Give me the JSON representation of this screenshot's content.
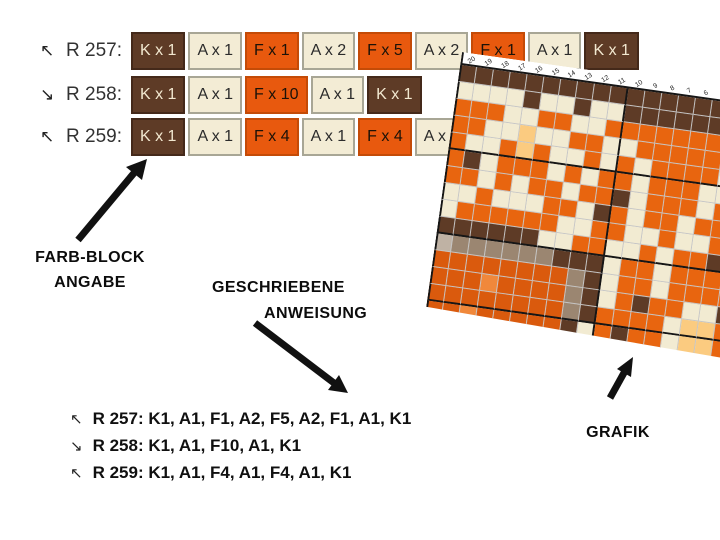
{
  "page": {
    "background": "#ffffff"
  },
  "block_colors": {
    "K": {
      "bg": "#5E3B26",
      "border": "#44291a",
      "meaning": "K"
    },
    "A": {
      "bg": "#F3ECD5",
      "border": "#a8a695",
      "meaning": "A"
    },
    "F": {
      "bg": "#E8590E",
      "border": "#c44b07",
      "meaning": "F"
    }
  },
  "instruction_rows": [
    {
      "arrow": "↖",
      "label": "R 257:",
      "blocks": [
        "K x 1",
        "A x 1",
        "F x 1",
        "A x 2",
        "F x 5",
        "A x 2",
        "F x 1",
        "A x 1",
        "K x 1"
      ]
    },
    {
      "arrow": "↘",
      "label": "R 258:",
      "blocks": [
        "K x 1",
        "A x 1",
        "F x 10",
        "A x 1",
        "K x 1"
      ]
    },
    {
      "arrow": "↖",
      "label": "R 259:",
      "blocks": [
        "K x 1",
        "A x 1",
        "F x 4",
        "A x 1",
        "F x 4",
        "A x 1",
        "K x 1"
      ]
    }
  ],
  "annotations": {
    "farb_block_line1": "FARB-BLOCK",
    "farb_block_line2": "ANGABE",
    "geschriebene_line1": "GESCHRIEBENE",
    "geschriebene_line2": "ANWEISUNG",
    "grafik": "GRAFIK"
  },
  "written_instructions": [
    {
      "arrow": "↖",
      "text": "R 257: K1, A1, F1, A2, F5, A2, F1, A1, K1"
    },
    {
      "arrow": "↘",
      "text": "R 258: K1, A1, F10, A1, K1"
    },
    {
      "arrow": "↖",
      "text": "R 259: K1, A1, F4, A1, F4, A1, K1"
    }
  ],
  "chart": {
    "column_numbers": [
      "20",
      "19",
      "18",
      "17",
      "16",
      "15",
      "14",
      "13",
      "12",
      "11",
      "10",
      "9",
      "8",
      "7",
      "6",
      "5",
      "4",
      "3",
      "2",
      "1"
    ],
    "palette": {
      "B": "#5E3B26",
      "C": "#F2EBD2",
      "O": "#E8650F",
      "D": "#DA5A0D",
      "P": "#FBCB80",
      "L": "#F0883B",
      "T": "#9B8671",
      "G": "#BFB2A4"
    },
    "bold_after_rows": [
      5,
      10,
      14
    ],
    "bold_after_col_index": 9,
    "rows": [
      "BBBBBBBBBBBBBBBBBBBB",
      "CCCCBCCBCCBBBBBBBBBB",
      "OOOCCOOCCOOOOOOOOCCO",
      "OOCCPCCOOCCOOOOOOOCO",
      "OCCOPOCCOCOCOOOOCOOO",
      "OBCOOOCOCOOCOOOCCOOO",
      "OOCOCOOCOOBCOOOCOOOB",
      "CCOCCCOOCBOCOOCOOOBO",
      "COOOOOOCCOOCCOCCOOCC",
      "BBBBBBCCOOCCOCOOBOCO",
      "GTTTTTTBBBCOOCOOOBCO",
      "DDDDDDDDTBCOOCOOOOCO",
      "DDDLDDDDTBCOBOOCCBCO",
      "DDDDDDDDTBOOOOCPPOOC",
      "DDLDDDDDBCOBOOCPPOOO"
    ]
  }
}
